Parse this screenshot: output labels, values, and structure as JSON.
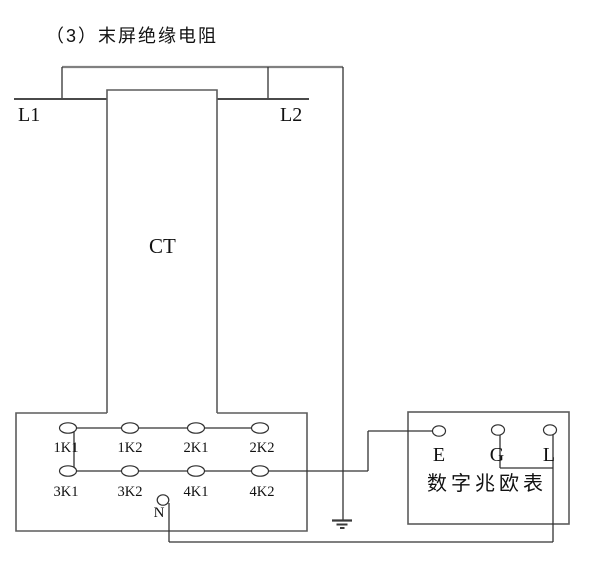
{
  "title": "（3）末屏绝缘电阻",
  "colors": {
    "background": "#ffffff",
    "wire": "#333333",
    "box_outline": "#5c5c5c",
    "text": "#111111"
  },
  "primary": {
    "left_terminal": "L1",
    "right_terminal": "L2"
  },
  "transformer": {
    "label": "CT"
  },
  "terminal_box": {
    "row1": [
      "1K1",
      "1K2",
      "2K1",
      "2K2"
    ],
    "row2": [
      "3K1",
      "3K2",
      "4K1",
      "4K2"
    ],
    "neutral": "N"
  },
  "megohmmeter": {
    "name": "数字兆欧表",
    "terminals": [
      "E",
      "G",
      "L"
    ]
  },
  "icons": {
    "ground": "earth-ground-icon"
  }
}
